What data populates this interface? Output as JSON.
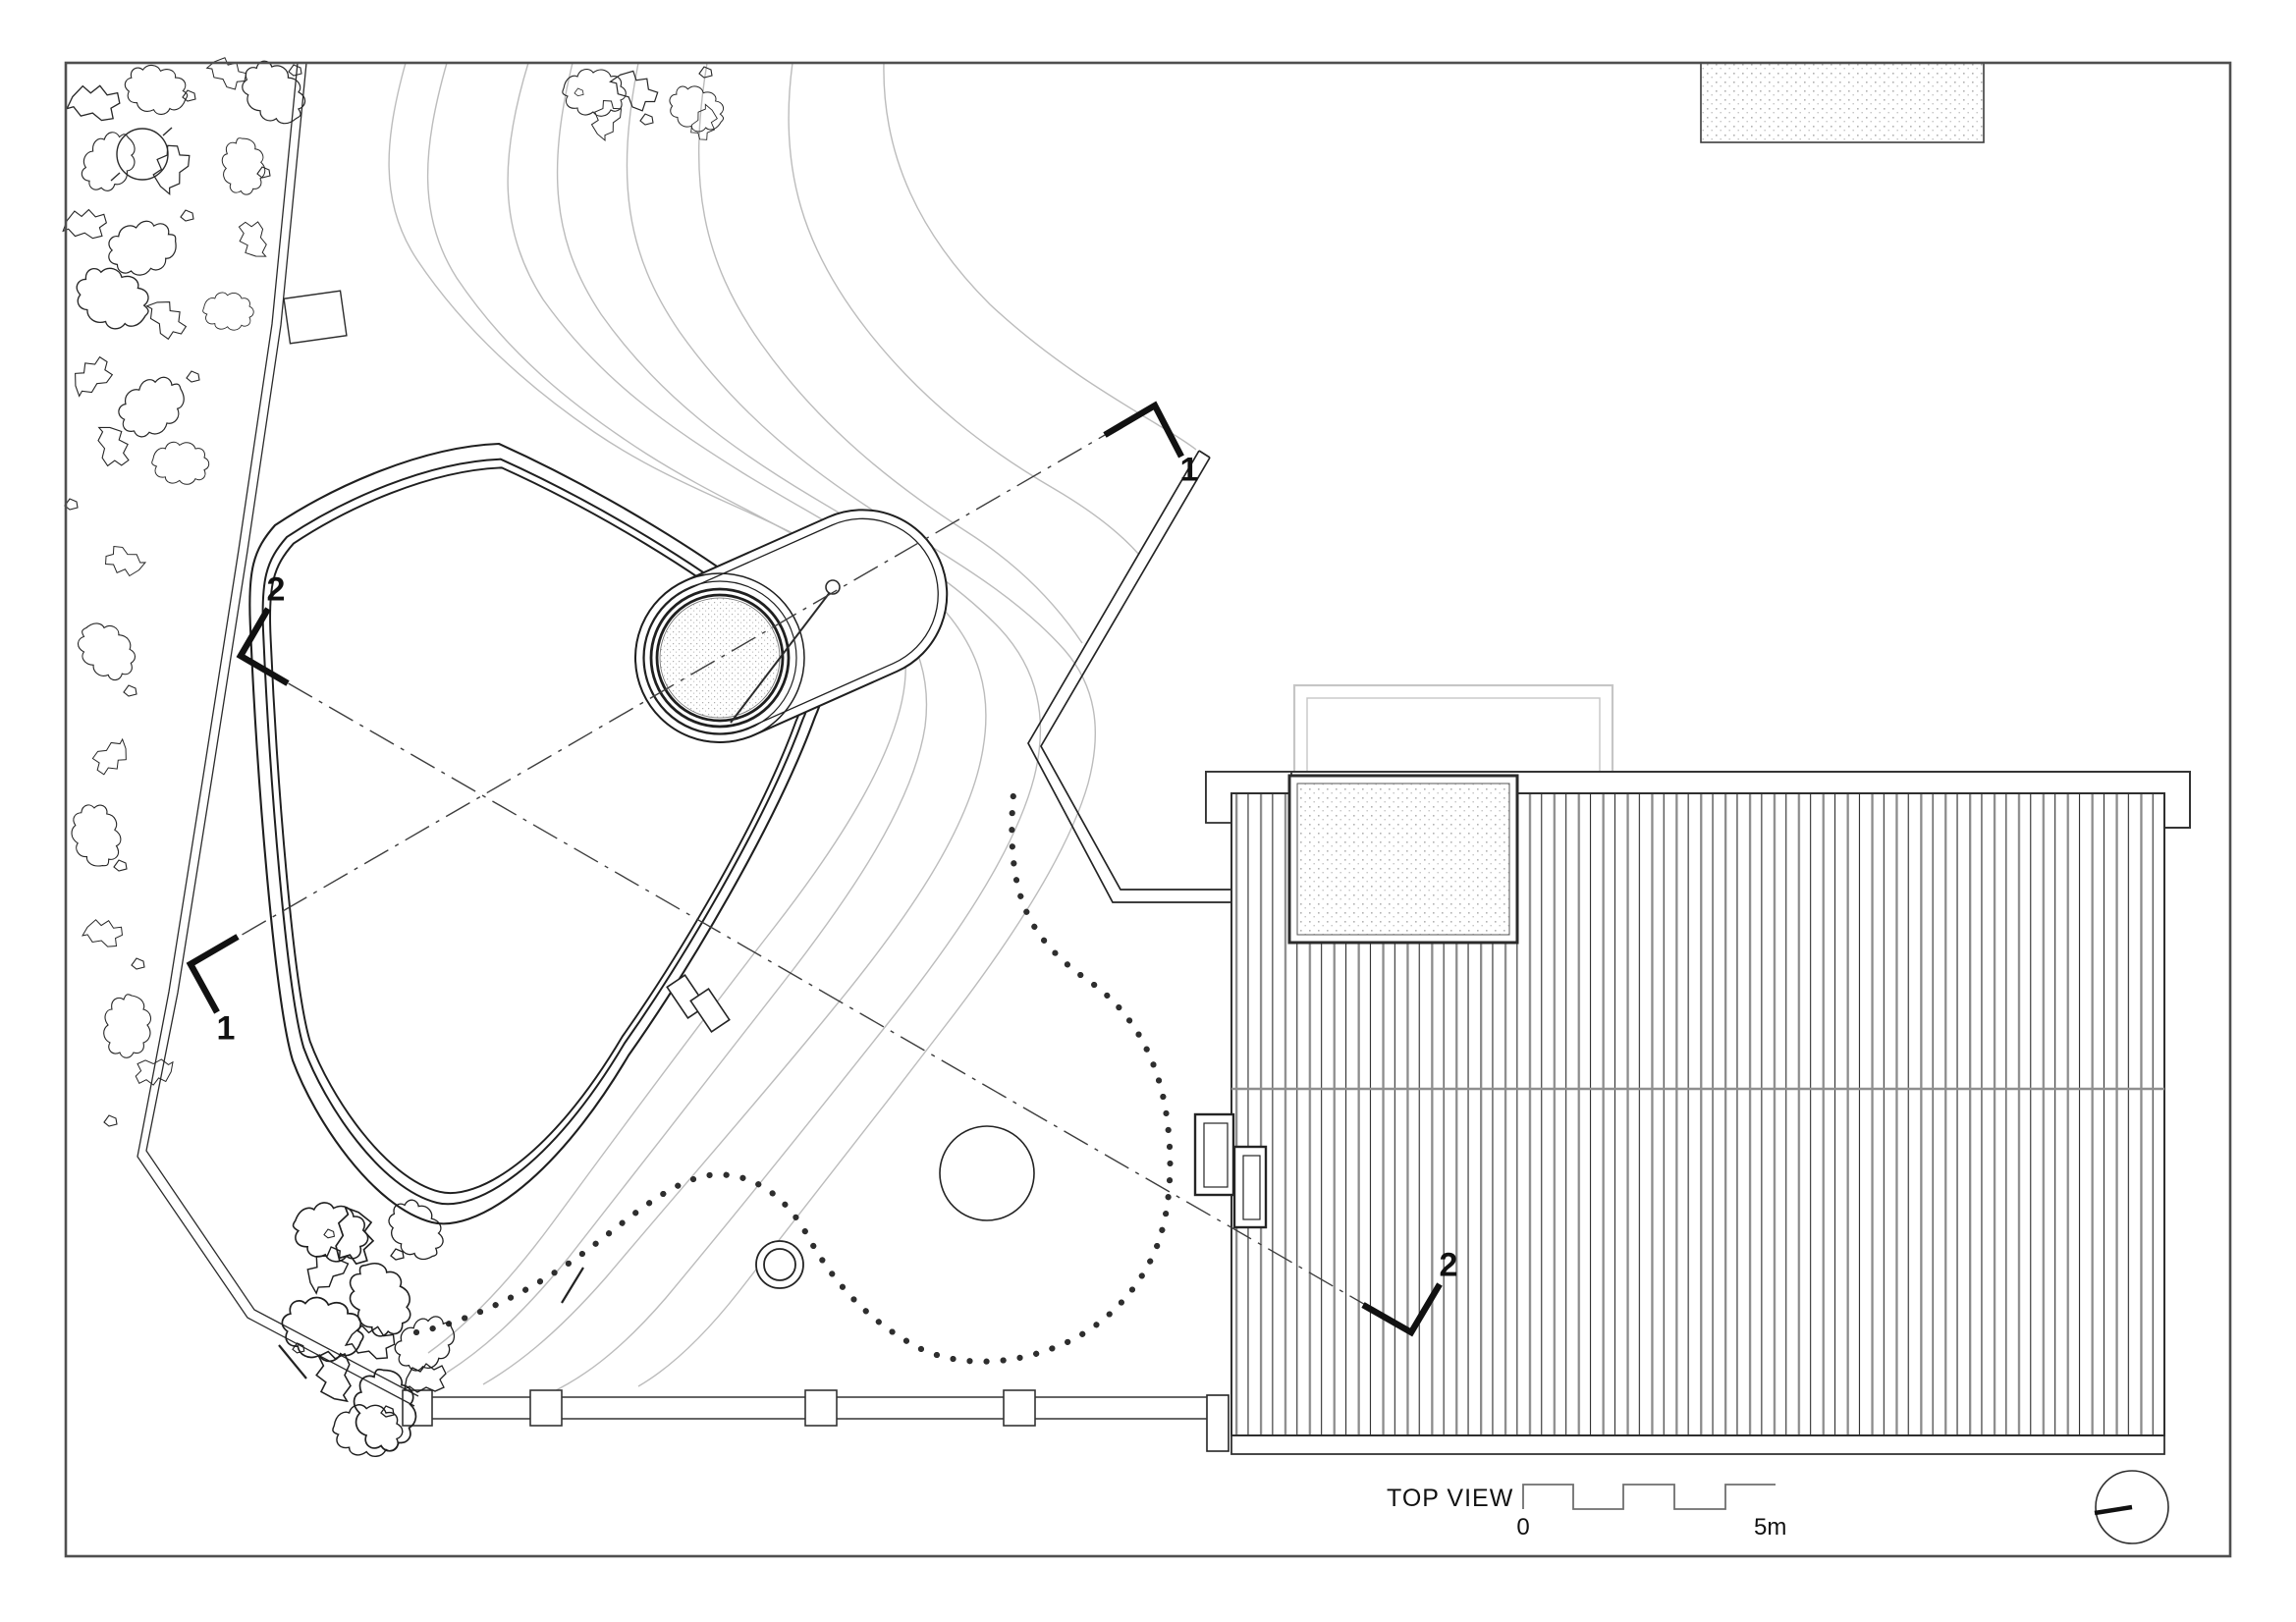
{
  "drawing": {
    "title": "TOP VIEW",
    "scale_bar": {
      "zero_label": "0",
      "end_label": "5m"
    },
    "section_markers": {
      "section_1_left": "1",
      "section_1_right": "1",
      "section_2_left": "2",
      "section_2_right": "2"
    },
    "colors": {
      "background": "#ffffff",
      "frame": "#4f4f4f",
      "line_dark": "#242424",
      "line_gray": "#8c8c8c",
      "contour_gray": "#bcbcbc",
      "underlay_gray": "#c6c6c6",
      "stipple_gray": "#9a9a9a"
    }
  }
}
